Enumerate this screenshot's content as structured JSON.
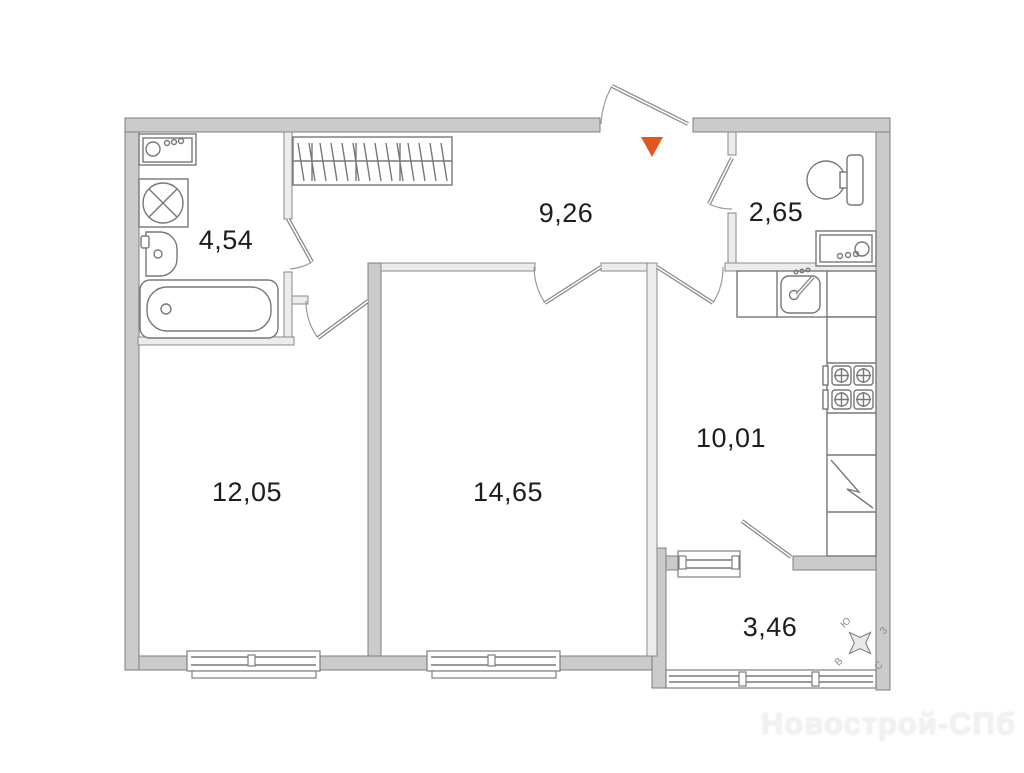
{
  "watermark": "Новострой-СПб",
  "entrance": {
    "marker_color": "#e2571d"
  },
  "rooms": {
    "bathroom": "4,54",
    "hallway": "9,26",
    "toilet": "2,65",
    "kitchen": "10,01",
    "room_left": "12,05",
    "room_center": "14,65",
    "balcony": "3,46"
  },
  "compass": {
    "north": "С",
    "south": "Ю",
    "east": "В",
    "west": "З"
  }
}
